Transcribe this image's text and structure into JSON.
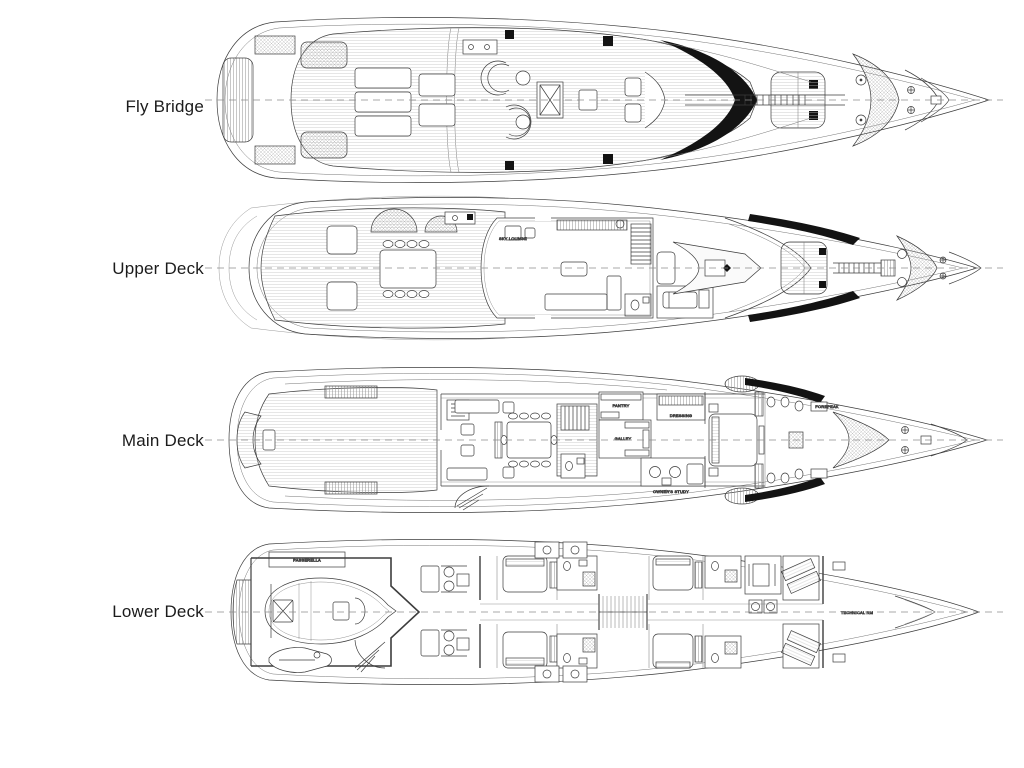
{
  "page": {
    "title": "Yacht deck plans",
    "background": "#ffffff"
  },
  "style": {
    "line": "#3d3d3d",
    "black": "#131313",
    "centerline": "#8c8c8c",
    "hatch": "#9a9a9a"
  },
  "decks": [
    {
      "id": "fly-bridge",
      "label": "Fly Bridge"
    },
    {
      "id": "upper-deck",
      "label": "Upper Deck"
    },
    {
      "id": "main-deck",
      "label": "Main Deck"
    },
    {
      "id": "lower-deck",
      "label": "Lower Deck"
    }
  ],
  "annotations": {
    "upper": {
      "sky_lounge": "SKY LOUNGE"
    },
    "main": {
      "pantry": "PANTRY",
      "galley": "GALLEY",
      "dressing": "DRESSING",
      "owners_study": "OWNER'S STUDY",
      "forepeak": "FOREPEAK"
    },
    "lower": {
      "passerella": "PASSERELLA",
      "technical_rm": "TECHNICAL RM"
    }
  }
}
